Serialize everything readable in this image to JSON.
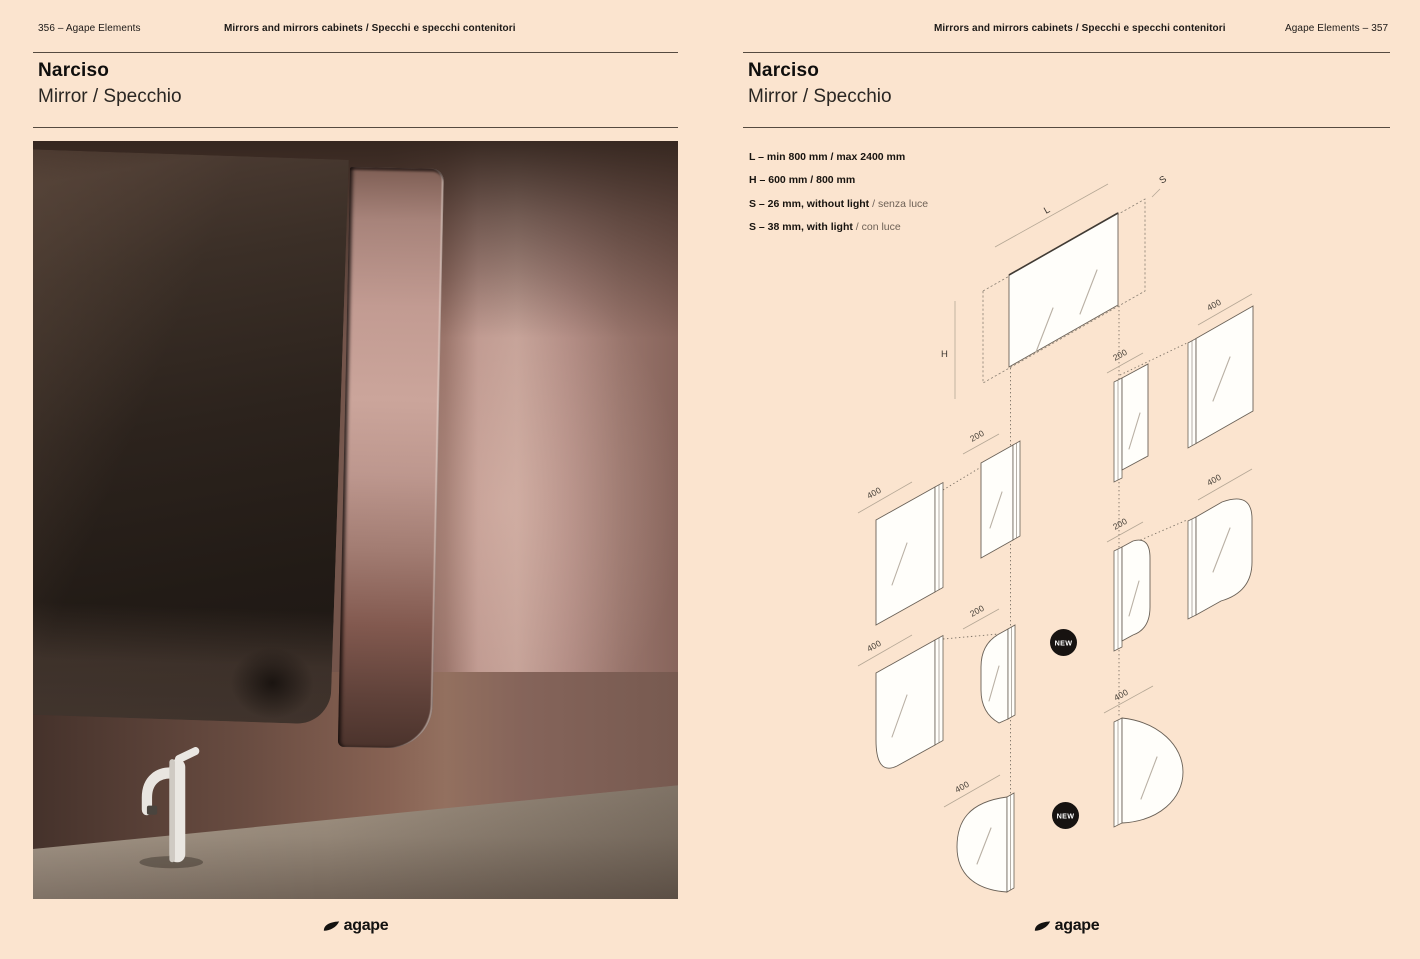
{
  "colors": {
    "background": "#fbe4cf",
    "rule": "#554a40",
    "text": "#17130f",
    "badge": "#171311"
  },
  "left_page": {
    "header": {
      "page_label": "356 – Agape Elements",
      "section_title": "Mirrors and mirrors cabinets / Specchi e specchi contenitori"
    },
    "title": "Narciso",
    "subtitle": "Mirror / Specchio",
    "photo_alt": "Narciso mirror detail in pink bathroom with white faucet",
    "logo_text": "agape"
  },
  "right_page": {
    "header": {
      "section_title": "Mirrors and mirrors cabinets / Specchi e specchi contenitori",
      "page_label": "Agape Elements – 357"
    },
    "title": "Narciso",
    "subtitle": "Mirror / Specchio",
    "specs": [
      {
        "bold": "L –  min 800 mm / max 2400 mm",
        "light": ""
      },
      {
        "bold": "H – 600 mm / 800 mm",
        "light": ""
      },
      {
        "bold": "S – 26 mm, without light",
        "light": " / senza luce"
      },
      {
        "bold": "S – 38 mm, with light",
        "light": " / con luce"
      }
    ],
    "diagram": {
      "dim_L": "L",
      "dim_H": "H",
      "dim_S": "S",
      "size_labels": {
        "a1": "400",
        "b1": "200",
        "c1b": "200",
        "c1": "400",
        "a2": "400",
        "b2": "200",
        "c2": "400",
        "c2b": "200",
        "b3": "400",
        "c3": "400"
      },
      "new_badge": "NEW"
    },
    "logo_text": "agape"
  }
}
